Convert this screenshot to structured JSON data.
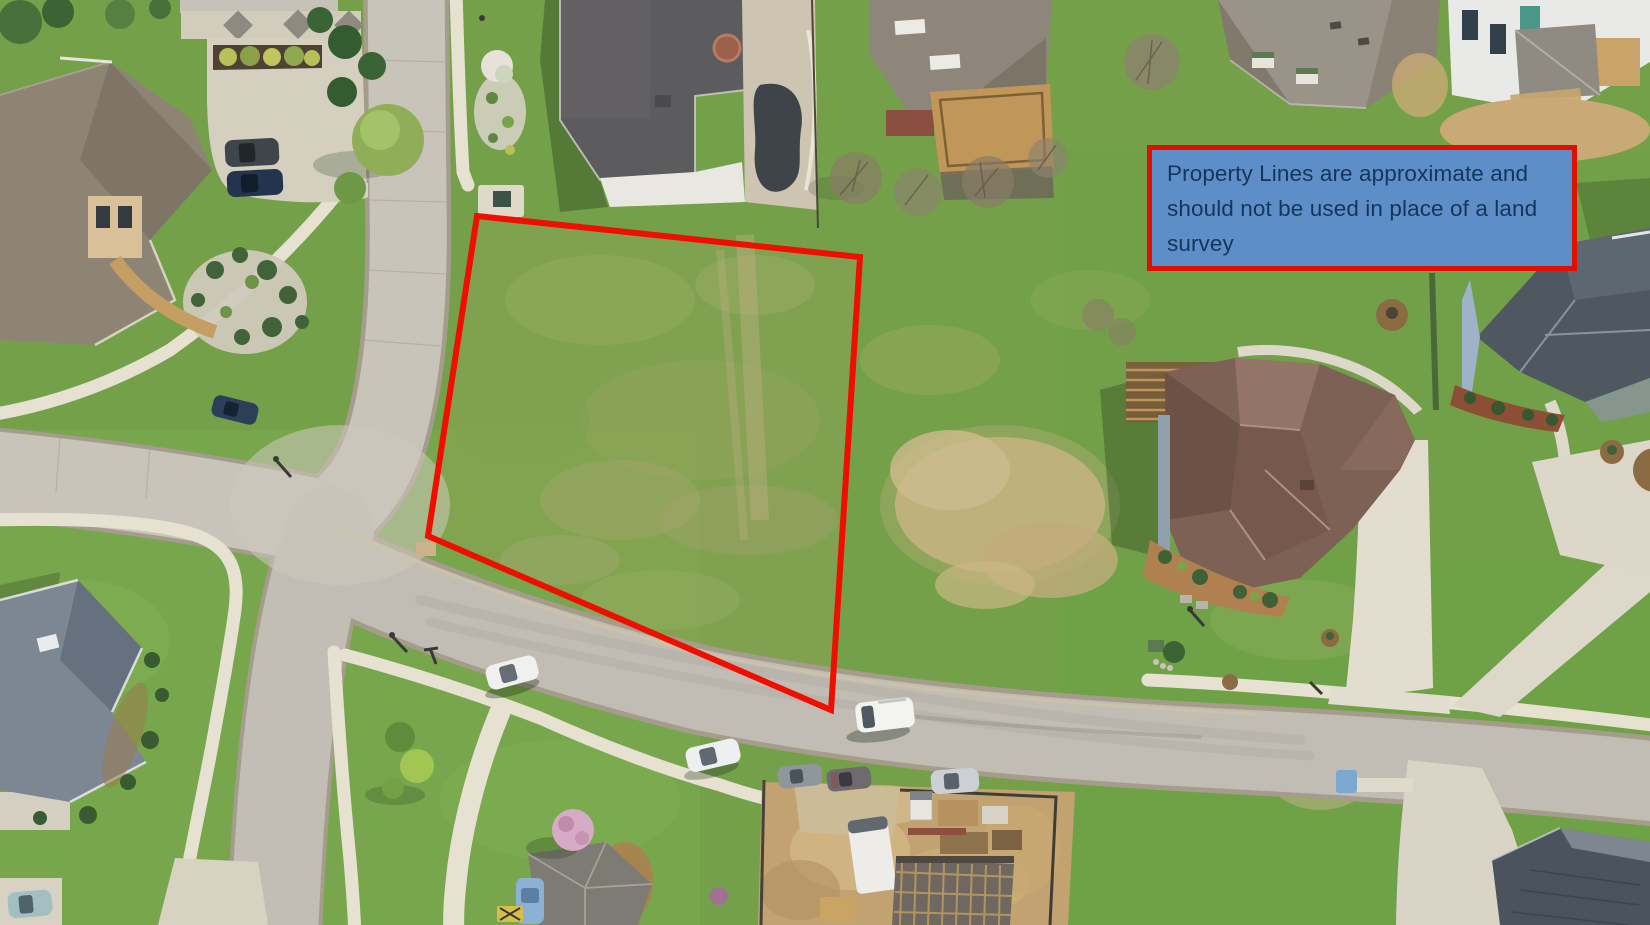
{
  "annotation": {
    "text": "Property Lines are approximate and should not be used in place of a land survey",
    "background_color": "#5d8ec8",
    "border_color": "#e01000",
    "text_color": "#14365c"
  },
  "property_boundary": {
    "color": "#ee0f00",
    "stroke_width": 6,
    "points": [
      [
        477,
        216
      ],
      [
        860,
        257
      ],
      [
        831,
        710
      ],
      [
        428,
        536
      ]
    ]
  },
  "scene": {
    "type": "aerial-drone-photo",
    "subject": "vacant residential lot outlined in red in a suburban neighborhood",
    "palette": {
      "grass": "#74a049",
      "dry_grass": "#c7b383",
      "road": "#c1bdb4",
      "sidewalk": "#e7e1d1",
      "driveway": "#dcd6c7",
      "dirt": "#c2a271",
      "roof_dark_gray": "#5c5b5d",
      "roof_taupe": "#8e8474",
      "roof_brown": "#7e6155",
      "roof_blue_gray": "#7c8793",
      "roof_charcoal": "#4f5860"
    }
  }
}
